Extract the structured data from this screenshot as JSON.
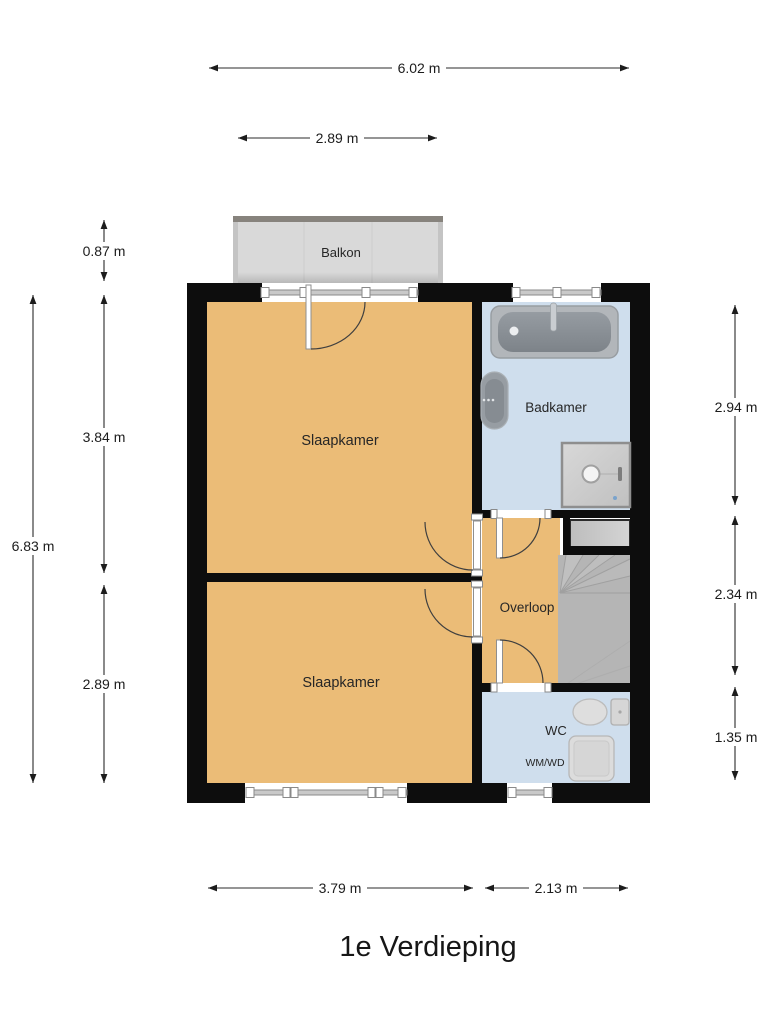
{
  "title": "1e Verdieping",
  "rooms": {
    "balkon": "Balkon",
    "slaapkamer_boven": "Slaapkamer",
    "badkamer": "Badkamer",
    "overloop": "Overloop",
    "slaapkamer_beneden": "Slaapkamer",
    "wc": "WC",
    "wm_wd": "WM/WD"
  },
  "dimensions": {
    "overall_width": "6.02 m",
    "balkon_width": "2.89 m",
    "balkon_depth": "0.87 m",
    "left_total": "6.83 m",
    "left_upper": "3.84 m",
    "left_lower": "2.89 m",
    "right_upper": "2.94 m",
    "right_middle": "2.34 m",
    "right_lower": "1.35 m",
    "bottom_left": "3.79 m",
    "bottom_right": "2.13 m"
  },
  "colors": {
    "room_warm": "#ebbc77",
    "room_wet": "#cfdeed",
    "wall": "#0d0d0d",
    "balcony_floor": "#d9d9d9",
    "stairs": "#b5b5b5"
  }
}
